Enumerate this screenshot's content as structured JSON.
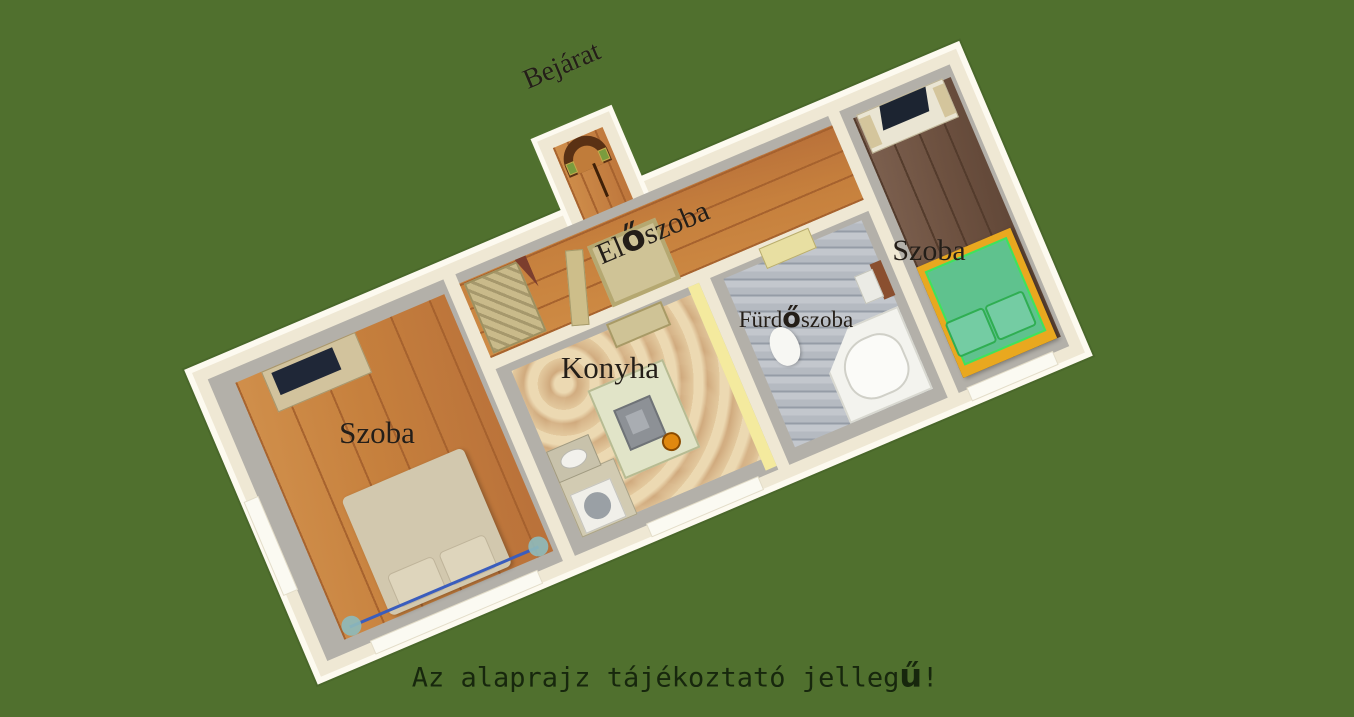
{
  "floorplan": {
    "entrance_label": "Bejárat",
    "hallway_label": "Előszoba",
    "room_left_label": "Szoba",
    "room_right_label": "Szoba",
    "kitchen_label": "Konyha",
    "bathroom_label": "Fürdőszoba",
    "caption": "Az alaprajz tájékoztató jellegű!",
    "colors": {
      "background": "#50702e",
      "wall_outer": "#efe8d4",
      "wall_rim": "#fdfaf0",
      "wall_face": "#b3b0a9",
      "wood_light": "#c6803d",
      "wood_dark": "#6d5140",
      "kitchen_floor": "#dcc092",
      "bath_tile": "#b5bac1",
      "bed_green": "#5fc28e",
      "bed_green_bright": "#3fe35b",
      "bed_beige": "#d2c8ae",
      "bed_frame": "#e9a81f",
      "yellow_band": "#f4ea9e",
      "label_text": "#241e18",
      "caption_text": "#17270d"
    }
  }
}
